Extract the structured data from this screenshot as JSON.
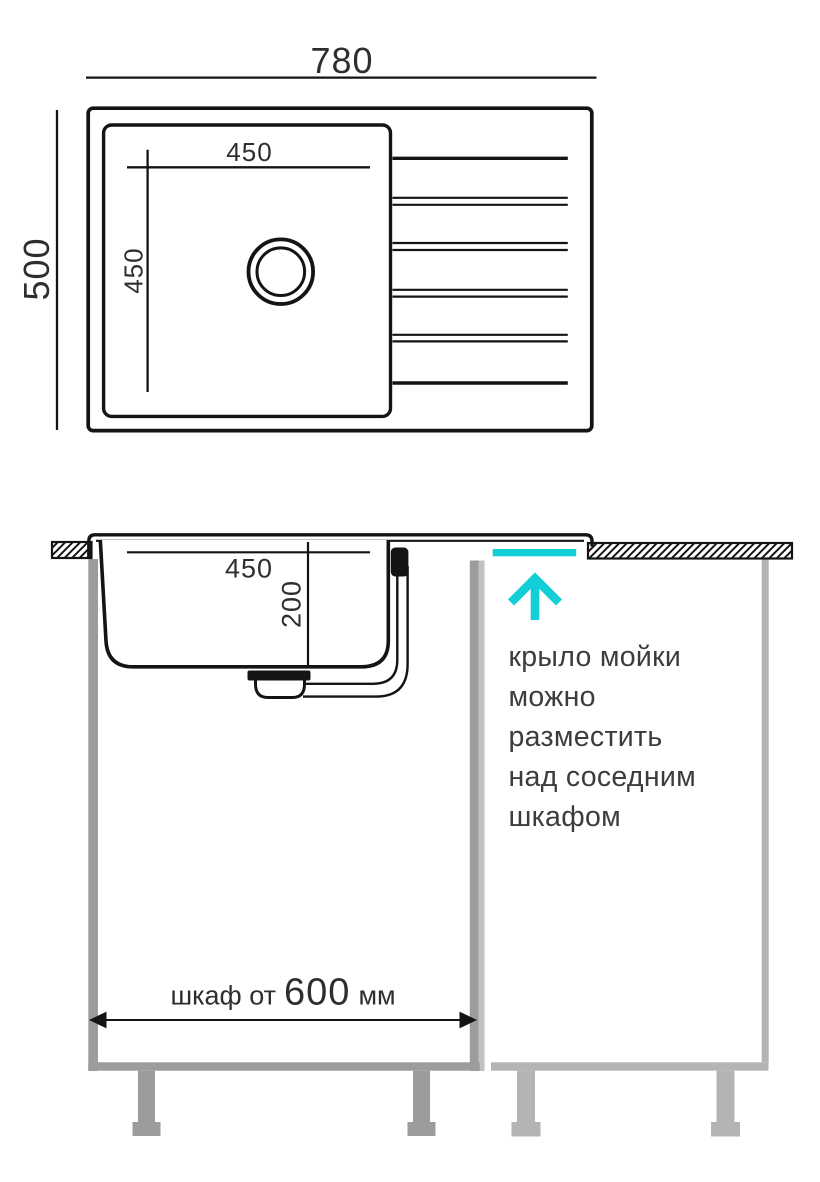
{
  "title": "sink-installation-drawing",
  "colors": {
    "accent_cyan": "#12CED6",
    "cabinet_left_gray": "#9C9C9C",
    "cabinet_right_gray": "#B4B4B4",
    "divider_light_gray": "#C2C2C2",
    "line_black": "#141414",
    "dim_text": "#2E2E2E",
    "annotation_text": "#3C3C3C"
  },
  "top_view": {
    "overall_width_label": "780",
    "overall_depth_label": "500",
    "bowl_width_label": "450",
    "bowl_depth_label": "450"
  },
  "side_view": {
    "bowl_width_label": "450",
    "bowl_depth_label": "200"
  },
  "cabinet_dimension": {
    "prefix": "шкаф от",
    "value": "600",
    "unit": "мм"
  },
  "annotation": {
    "lines": [
      "крыло мойки",
      "можно",
      "разместить",
      "над соседним",
      "шкафом"
    ]
  }
}
